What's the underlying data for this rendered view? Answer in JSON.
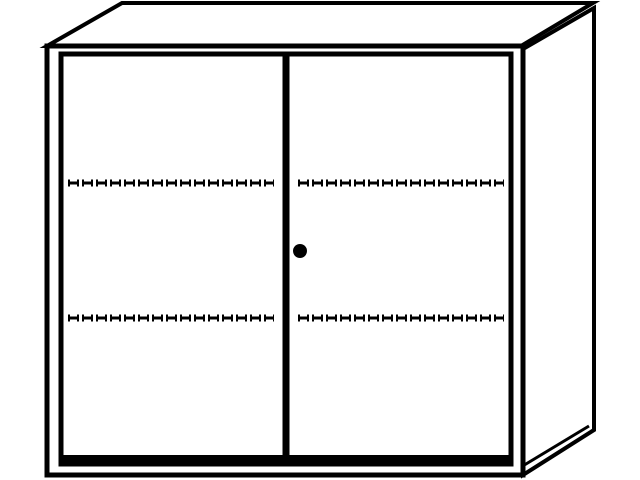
{
  "drawing": {
    "subject": "two-door-cabinet-line-drawing",
    "colors": {
      "line": "#000000",
      "background": "#ffffff",
      "fill": "#ffffff"
    },
    "canvas": {
      "width": 640,
      "height": 480,
      "viewbox": "0 0 640 480"
    },
    "top_face": {
      "points": "47,46 122,3 593,3 521,46"
    },
    "side_panel": {
      "points": "523,49 594,8 594,430 523,475",
      "bottom_inner_edge": {
        "x1": 521,
        "y1": 467,
        "x2": 589,
        "y2": 426
      }
    },
    "front_frame": {
      "x": 47,
      "y": 46,
      "width": 476,
      "height": 429
    },
    "door_frame": {
      "x": 61,
      "y": 54,
      "width": 450,
      "height": 410
    },
    "door_bottom_rail": {
      "x1": 59,
      "y1": 459,
      "x2": 513,
      "y2": 459
    },
    "divider": {
      "x": 286,
      "y1": 54,
      "y2": 461
    },
    "shelf_lines": [
      {
        "door": "left",
        "x1": 68,
        "x2": 274,
        "y": 183
      },
      {
        "door": "right",
        "x1": 298,
        "x2": 504,
        "y": 183
      },
      {
        "door": "left",
        "x1": 68,
        "x2": 274,
        "y": 318
      },
      {
        "door": "right",
        "x1": 298,
        "x2": 504,
        "y": 318
      }
    ],
    "lock": {
      "cx": 300,
      "cy": 251,
      "r": 7
    }
  }
}
